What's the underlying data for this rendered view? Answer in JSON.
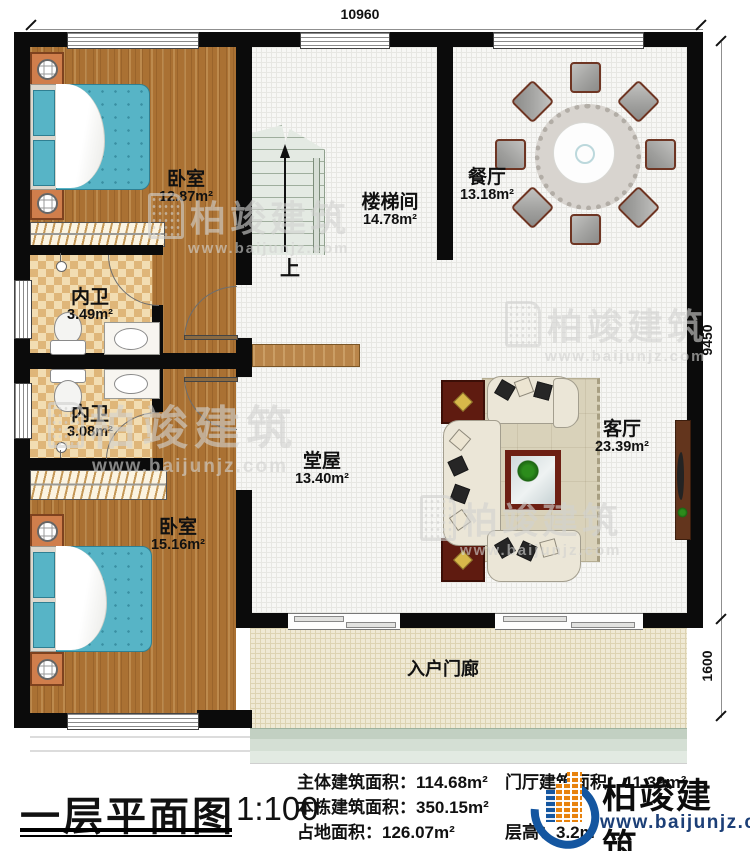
{
  "dimensions": {
    "top": "10960",
    "right_main": "9450",
    "right_porch": "1600"
  },
  "rooms": {
    "bedroom1": {
      "name": "卧室",
      "area": "12.87m²"
    },
    "stairwell": {
      "name": "楼梯间",
      "area": "14.78m²"
    },
    "dining": {
      "name": "餐厅",
      "area": "13.18m²"
    },
    "bath1": {
      "name": "内卫",
      "area": "3.49m²"
    },
    "bath2": {
      "name": "内卫",
      "area": "3.08m²"
    },
    "bedroom2": {
      "name": "卧室",
      "area": "15.16m²"
    },
    "hall": {
      "name": "堂屋",
      "area": "13.40m²"
    },
    "living": {
      "name": "客厅",
      "area": "23.39m²"
    },
    "porch": {
      "name": "入户门廊"
    }
  },
  "stairs": {
    "up_label": "上"
  },
  "footer": {
    "title": "一层平面图",
    "scale": "1:100",
    "stats": [
      {
        "text": "主体建筑面积：114.68m²"
      },
      {
        "text": "门厅建筑面积：11.39m²"
      },
      {
        "text": "本栋建筑面积：350.15m²"
      },
      {
        "text": "占地面积：126.07m²"
      },
      {
        "text": "层高：3.2m"
      }
    ]
  },
  "brand": {
    "name": "柏竣建筑",
    "website": "www.baijunjz.com"
  },
  "watermark": {
    "name": "柏竣建筑",
    "website": "www.baijunjz.com"
  },
  "colors": {
    "wall": "#0b0b0b",
    "wood": "#aa7133",
    "bed": "#57b4c6",
    "tile": "#dfb679",
    "maroon": "#5f1b10",
    "brand_blue": "#1456a0",
    "brand_orange": "#e8820c"
  }
}
